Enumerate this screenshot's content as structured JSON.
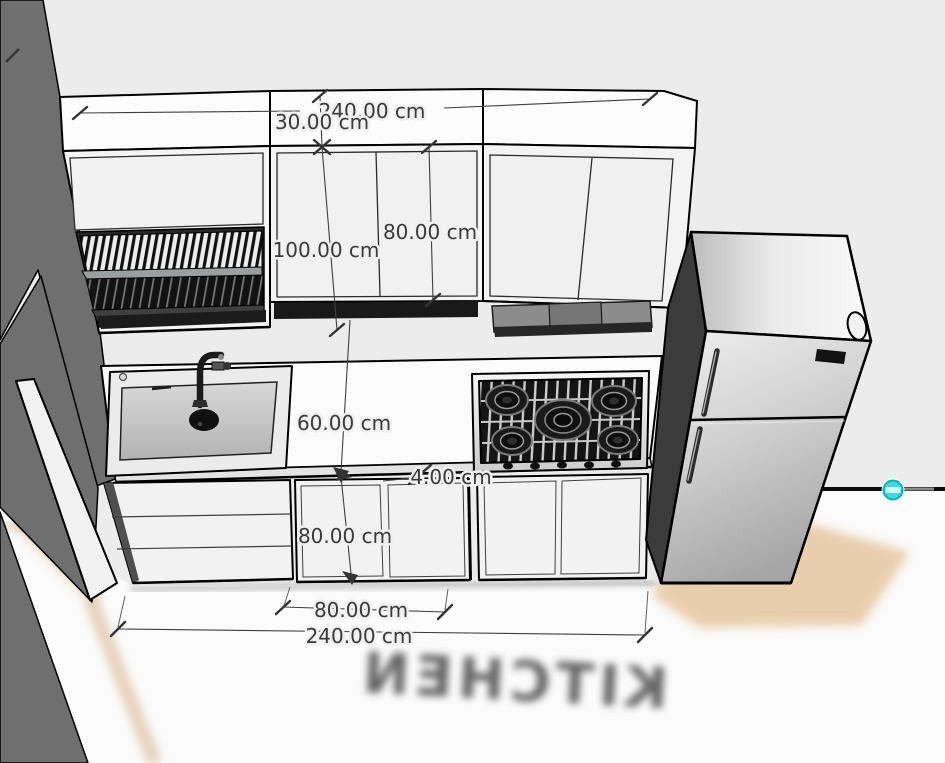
{
  "scene": {
    "floor_label": "KITCHEN",
    "dimensions": {
      "top_total_width": "240.00 cm",
      "soffit_height": "30.00 cm",
      "left_upper_cabinet_height": "100.00 cm",
      "upper_cabinet_height": "80.00 cm",
      "backsplash_height": "60.00 cm",
      "countertop_thickness": "4.00 cm",
      "base_cabinet_height": "80.00 cm",
      "base_cabinet_width": "80.00 cm",
      "total_width": "240.00 cm"
    },
    "objects": [
      "upper-cabinets",
      "dish-rack",
      "range-hood",
      "sink",
      "faucet",
      "gas-cooktop-5-burner",
      "countertop",
      "drawer-unit",
      "base-cabinets",
      "refrigerator",
      "side-wall",
      "floor"
    ],
    "icons": {
      "section_widget": "cyan-circle-minus"
    },
    "colors": {
      "wall_background": "#ECECEC",
      "side_wall_gray": "#6F6F6F",
      "cabinet_white": "#F4F4F4",
      "outline_black": "#000000",
      "dimension_text": "#3A3A3A",
      "floor_tan": "#E2BF92",
      "widget_cyan": "#3ED8D8"
    }
  }
}
